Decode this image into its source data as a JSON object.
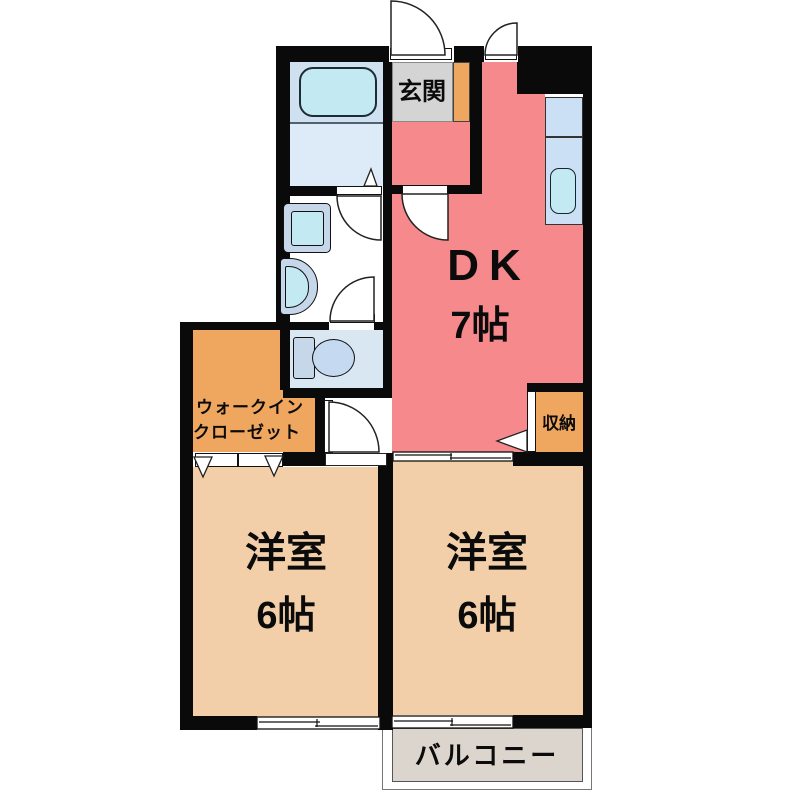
{
  "floorplan": {
    "rooms": {
      "dk": {
        "label": "DK",
        "size": "7帖"
      },
      "bedroom_left": {
        "label": "洋室",
        "size": "6帖"
      },
      "bedroom_right": {
        "label": "洋室",
        "size": "6帖"
      },
      "genkan": {
        "label": "玄関"
      },
      "walkin_closet": {
        "line1": "ウォークイン",
        "line2": "クローゼット"
      },
      "storage": {
        "label": "収納"
      },
      "balcony": {
        "label": "バルコニー"
      }
    },
    "colors": {
      "wall": "#0a0a0a",
      "dk": "#F5898B",
      "room": "#F2CFA9",
      "orange": "#EFA75F",
      "genkan": "#D4D4D4",
      "bathtop": "#CFE0F1",
      "bathfloor": "#DDEBF9",
      "cyan": "#C3E9F2",
      "fixture": "#C7D7EA",
      "toiletfloor": "#D9E7F3",
      "bowl": "#C5D9F0",
      "counter": "#CBDFF5",
      "balcony": "#DCD5CE"
    }
  }
}
